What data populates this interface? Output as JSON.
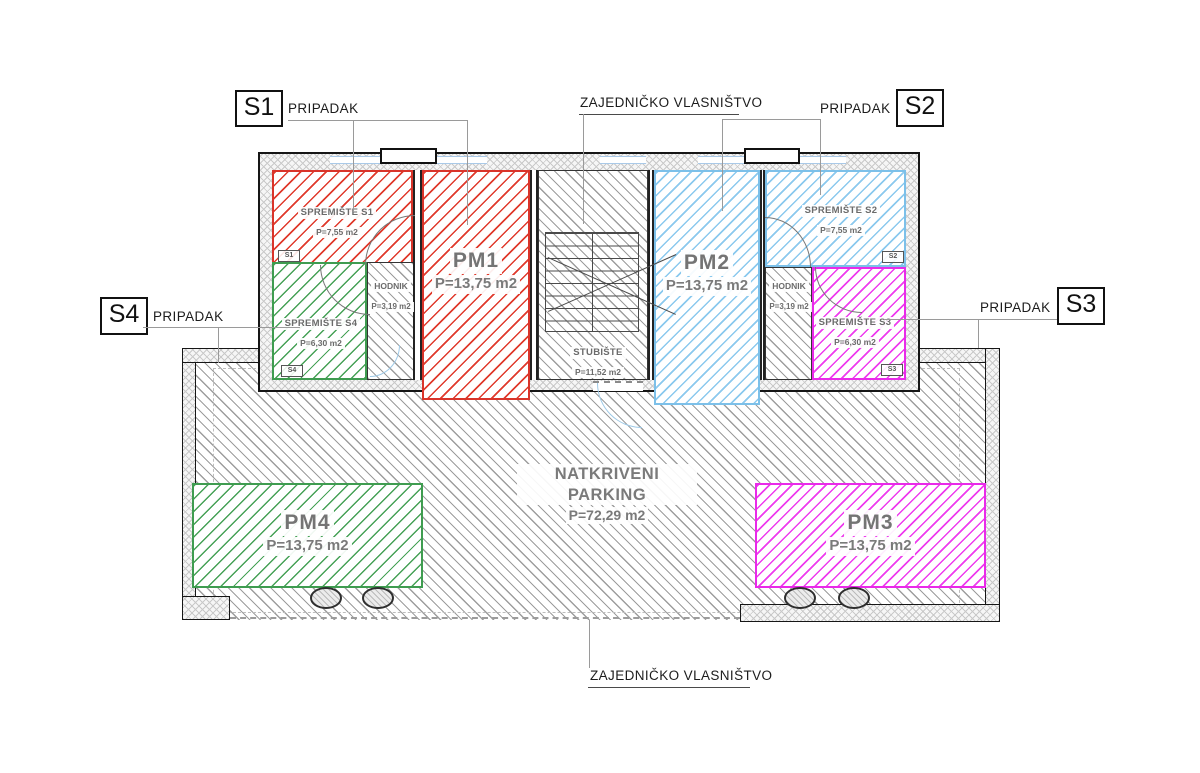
{
  "annotations": {
    "unit_s1": {
      "code": "S1",
      "label": "PRIPADAK"
    },
    "unit_s2": {
      "code": "S2",
      "label": "PRIPADAK"
    },
    "unit_s3": {
      "code": "S3",
      "label": "PRIPADAK"
    },
    "unit_s4": {
      "code": "S4",
      "label": "PRIPADAK"
    },
    "common_top": "ZAJEDNIČKO VLASNIŠTVO",
    "common_bottom": "ZAJEDNIČKO VLASNIŠTVO"
  },
  "rooms": {
    "spremiste_s1": {
      "name": "SPREMIŠTE S1",
      "area": "P=7,55 m2",
      "tag": "S1"
    },
    "spremiste_s2": {
      "name": "SPREMIŠTE S2",
      "area": "P=7,55 m2",
      "tag": "S2"
    },
    "spremiste_s3": {
      "name": "SPREMIŠTE S3",
      "area": "P=6,30 m2",
      "tag": "S3"
    },
    "spremiste_s4": {
      "name": "SPREMIŠTE S4",
      "area": "P=6,30 m2",
      "tag": "S4"
    },
    "hodnik_left": {
      "name": "HODNIK",
      "area": "P=3,19 m2"
    },
    "hodnik_right": {
      "name": "HODNIK",
      "area": "P=3,19 m2"
    },
    "stubiste": {
      "name": "STUBIŠTE",
      "area": "P=11,52 m2"
    },
    "pm1": {
      "name": "PM1",
      "area": "P=13,75 m2"
    },
    "pm2": {
      "name": "PM2",
      "area": "P=13,75 m2"
    },
    "pm3": {
      "name": "PM3",
      "area": "P=13,75 m2"
    },
    "pm4": {
      "name": "PM4",
      "area": "P=13,75 m2"
    },
    "parking": {
      "name": "NATKRIVENI PARKING",
      "area": "P=72,29 m2"
    }
  },
  "colors": {
    "red": "#d9342a",
    "green": "#3f9c50",
    "blue": "#7cc0e9",
    "magenta": "#e92ae9",
    "window_blue": "#a9c9e8",
    "wall_outline": "#161616",
    "hatch_gray": "#9d9d9d",
    "label_gray": "#6b6b6b"
  }
}
